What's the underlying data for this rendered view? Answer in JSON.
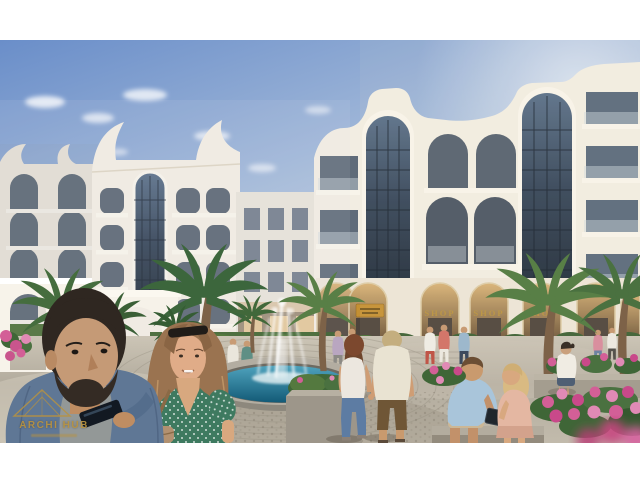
{
  "scene": {
    "type": "architectural-visualization",
    "subject": "Residential compound with curved white facades, plaza fountain, palm trees, shop arcade and pedestrians",
    "watermark": {
      "title": "ARCHI HUB"
    },
    "shops": {
      "sign_labels": [
        "SHOP",
        "SHOP",
        "SHOP"
      ]
    },
    "colors": {
      "sky_top": "#6a8ec9",
      "sky_mid": "#a9bedb",
      "sky_horizon": "#e9edf0",
      "facade": "#f2ede2",
      "facade_shade": "#ddd5c5",
      "glass_dark": "#36465a",
      "gold": "#b8923f",
      "water": "#2b7fa2",
      "pavement": "#bdb6a8",
      "palm_dark": "#3c663c",
      "palm_light": "#587f46",
      "flower_pink": "#d35f97",
      "frame": "#ffffff"
    }
  }
}
